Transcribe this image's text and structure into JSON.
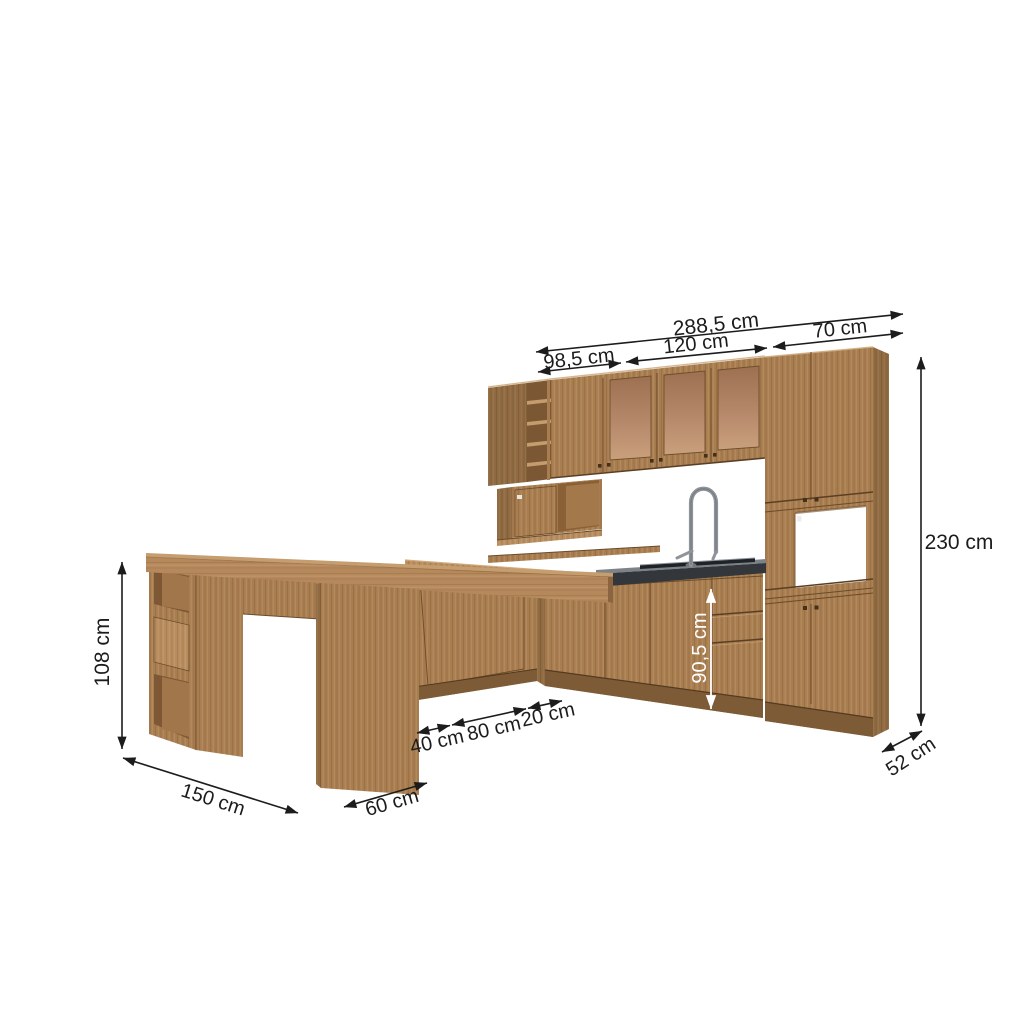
{
  "figure": {
    "type": "kitchen-cabinet-set-dimension-diagram",
    "unit": "cm",
    "description": "Wood-finish modular kitchen set with wall cabinets, glass-door cabinet, tall tower with microwave niche, sink base run, corner base cabinet and bar table with open shelves, annotated with dimension arrows"
  },
  "dims": {
    "total_width": "288,5 cm",
    "upper_left_width": "98,5 cm",
    "upper_center_width": "120 cm",
    "tower_width": "70 cm",
    "total_height": "230 cm",
    "tower_depth": "52 cm",
    "counter_height": "90,5 cm",
    "seg_40": "40 cm",
    "seg_80": "80 cm",
    "seg_20": "20 cm",
    "table_height": "108 cm",
    "table_length": "150 cm",
    "table_depth": "60 cm"
  },
  "colors": {
    "background": "#ffffff",
    "wood": "#a87e50",
    "wood_dark": "#8f6a42",
    "wood_light": "#b78d5f",
    "plinth": "#7d5b37",
    "countertop": "#33373c",
    "countertop_top": "#7d8287",
    "glass": "#b5886a",
    "dimension_line": "#1c1c1c",
    "dimension_text_light": "#ffffff"
  }
}
